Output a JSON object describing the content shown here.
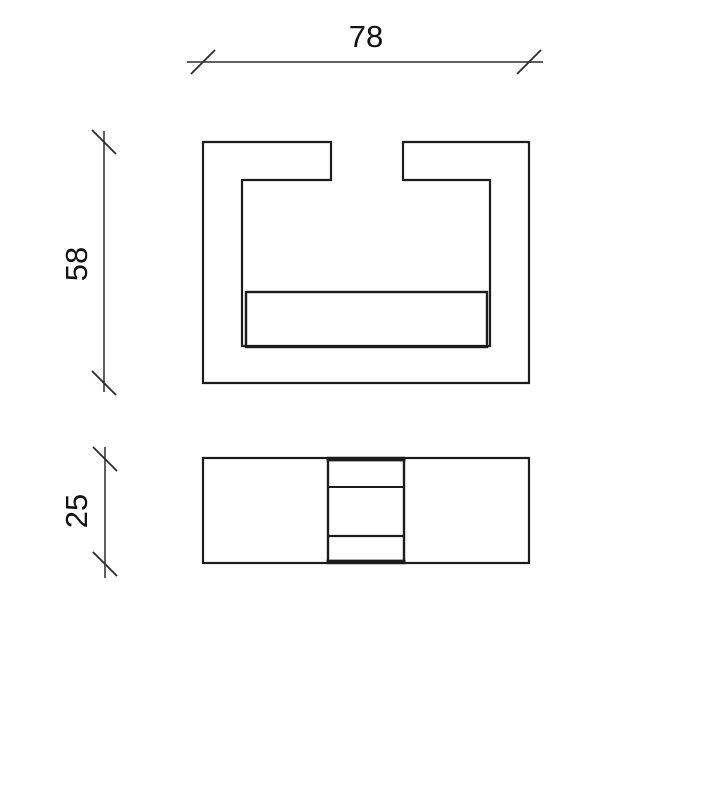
{
  "colors": {
    "background": "#ffffff",
    "line": "#1c1c1c",
    "dimension": "#2b2b2b",
    "text": "#111111"
  },
  "drawing": {
    "type": "technical_drawing",
    "description": "Two orthographic views of a C-channel profile with an inner insert plate",
    "views": [
      {
        "name": "front-view",
        "shape": "c-channel-profile",
        "width": 78,
        "height": 58
      },
      {
        "name": "bottom-view",
        "shape": "plan-rectangle-with-center-block",
        "depth": 25
      }
    ],
    "dimensions": [
      {
        "name": "width",
        "label": "78",
        "value": 78,
        "orientation": "horizontal"
      },
      {
        "name": "height",
        "label": "58",
        "value": 58,
        "orientation": "vertical"
      },
      {
        "name": "depth",
        "label": "25",
        "value": 25,
        "orientation": "vertical"
      }
    ]
  }
}
